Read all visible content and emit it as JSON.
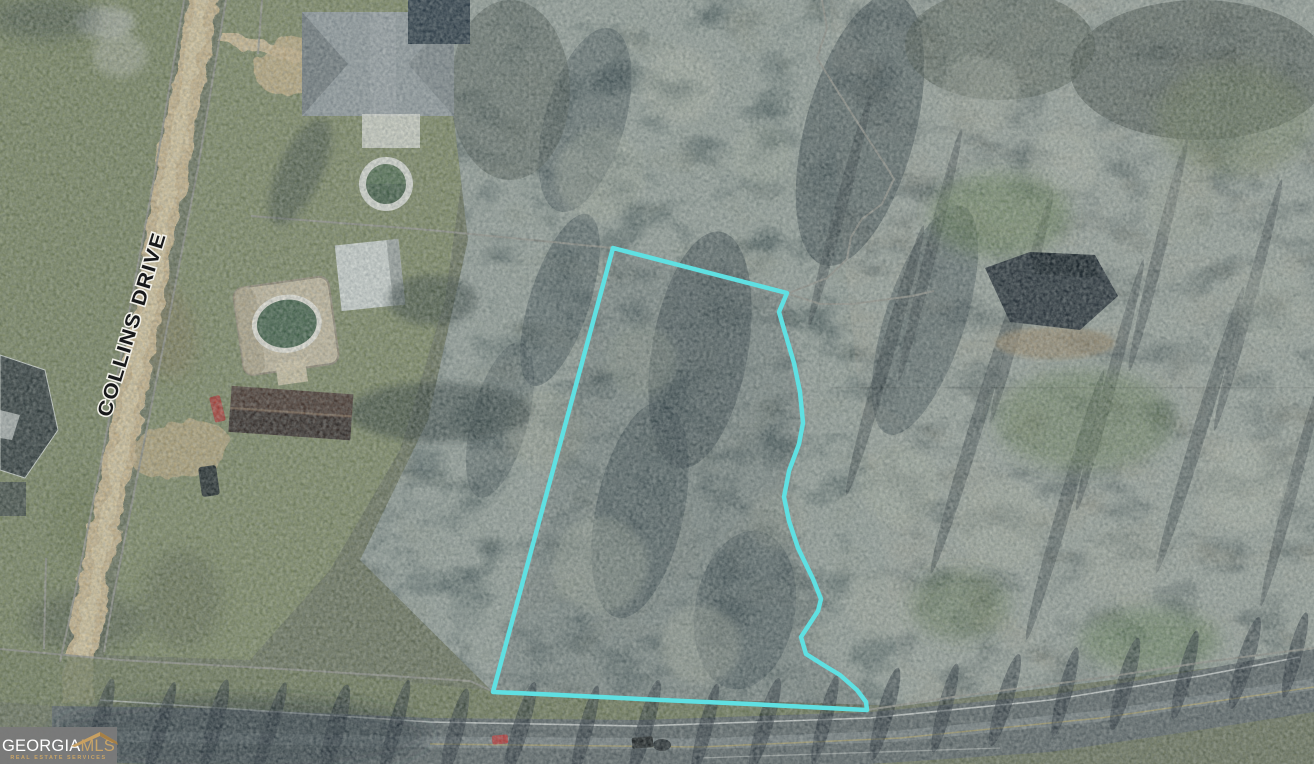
{
  "map": {
    "street_label": "COLLINS DRIVE",
    "parcel_outline_color": "#5fe0e2",
    "boundary_line_color": "#8d8d85",
    "parcel_path": "M613,248 L787,293 L779,312 L786,336 L794,363 L800,392 L803,423 L799,444 L789,471 L784,497 L789,521 L798,548 L813,579 L821,599 L818,611 L801,637 L806,654 L825,666 L840,675 L857,690 L866,702 L867,710 L750,704 L640,699 L560,695 L493,692 Z"
  },
  "watermark": {
    "brand_part1": "GEORGIA",
    "brand_part2": "MLS",
    "tagline": "REAL ESTATE SERVICES",
    "background": "#7a7a7a",
    "accent": "#c8a468",
    "text_color": "#ffffff"
  }
}
